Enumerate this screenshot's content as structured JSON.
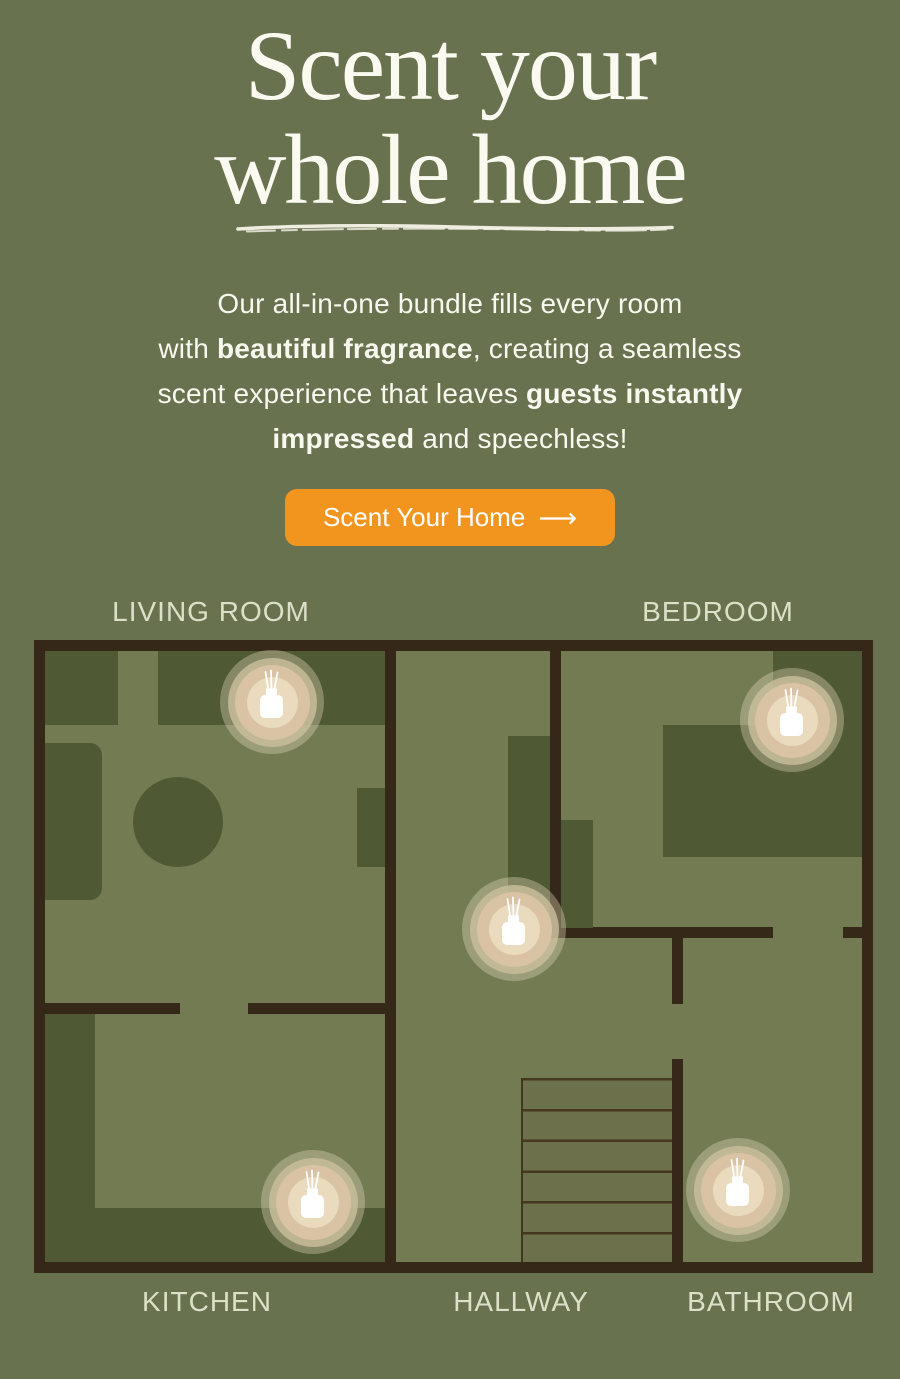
{
  "palette": {
    "background_green": "#68724F",
    "floor_green": "#737B53",
    "furniture_green": "#4F5933",
    "wall_brown": "#362818",
    "accent_orange": "#F2951F",
    "heading_white": "#FBFAF1",
    "label_sage": "#DCE0C8",
    "diffuser_tan": "#D9C3A4",
    "diffuser_tan_light": "#EADABE"
  },
  "hero": {
    "title_line1": "Scent your",
    "title_line2": "whole home",
    "paragraph": {
      "l1": "Our all-in-one bundle fills every room",
      "l2a": "with ",
      "l2b": "beautiful fragrance",
      "l2c": ", creating a seamless",
      "l3a": "scent experience that leaves ",
      "l3b": "guests instantly",
      "l4a": "impressed",
      "l4b": " and speechless!"
    },
    "cta_label": "Scent Your Home",
    "cta_arrow": "⟶"
  },
  "floorplan": {
    "room_labels": {
      "living_room": "LIVING ROOM",
      "bedroom": "BEDROOM",
      "kitchen": "KITCHEN",
      "hallway": "HALLWAY",
      "bathroom": "BATHROOM"
    },
    "diffuser_rooms": [
      "living room",
      "bedroom",
      "hallway",
      "kitchen",
      "bathroom"
    ]
  },
  "icons": {
    "cta_arrow": "long-right-arrow",
    "diffuser_marker": "reed-diffuser-bottle"
  }
}
